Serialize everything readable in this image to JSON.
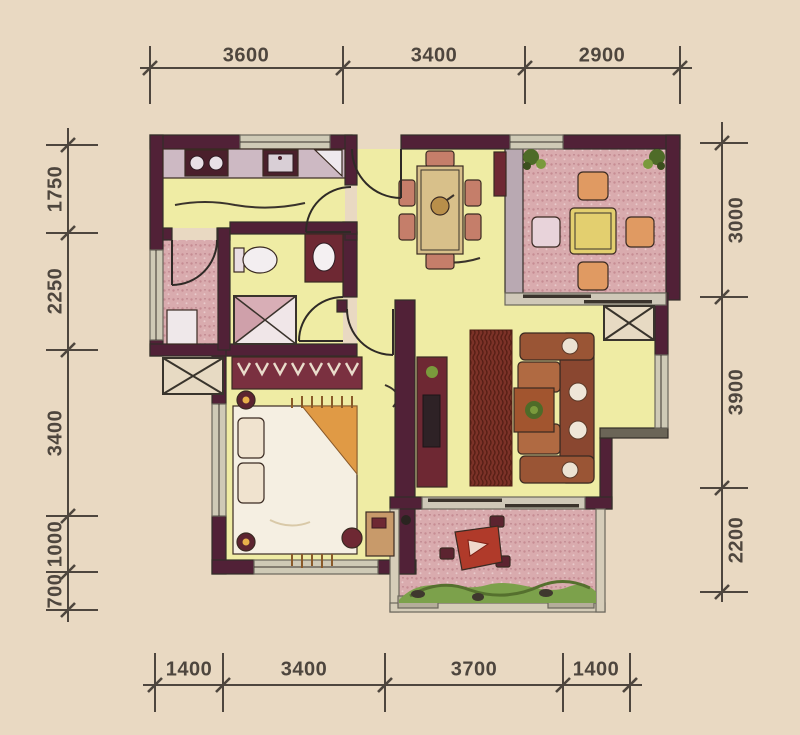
{
  "dimensions": {
    "top": [
      "3600",
      "3400",
      "2900"
    ],
    "bottom": [
      "1400",
      "3400",
      "3700",
      "1400"
    ],
    "left": [
      "1750",
      "2250",
      "3400",
      "1000",
      "700"
    ],
    "right": [
      "3000",
      "3900",
      "2200"
    ]
  },
  "rooms": [
    "kitchen",
    "laundry-balcony",
    "bathroom",
    "dining-area",
    "living-room",
    "bedroom",
    "leisure-balcony",
    "garden-balcony"
  ],
  "fixtures": [
    "stove",
    "kitchen-sink",
    "kitchen-counter",
    "toilet",
    "wash-basin-counter",
    "shower",
    "washing-machine",
    "dining-table",
    "dining-chairs",
    "balcony-table",
    "balcony-chairs",
    "corner-plants",
    "sofa-set",
    "coffee-table",
    "plant-pot",
    "area-rug",
    "tv-cabinet",
    "wardrobe",
    "double-bed",
    "pillows",
    "bedside-lamps",
    "dressing-table",
    "stool",
    "ac-platform",
    "garden-bed",
    "patio-table-set",
    "sliding-door",
    "swing-door"
  ],
  "colors": {
    "background": "#e9d9c2",
    "wall": "#512137",
    "floor": "#efeca4",
    "tile": "#d9abae",
    "window": "#cfcab6",
    "furniture_dark": "#6e2833",
    "counter": "#cdb9c3",
    "wood": "#c89a6a",
    "sofa": "#b06a42",
    "rug": "#7c3228",
    "plant_dark": "#4e6b28",
    "plant_light": "#7a9a3c",
    "accent_red": "#b03a2a",
    "dim_text": "#4e463e"
  }
}
